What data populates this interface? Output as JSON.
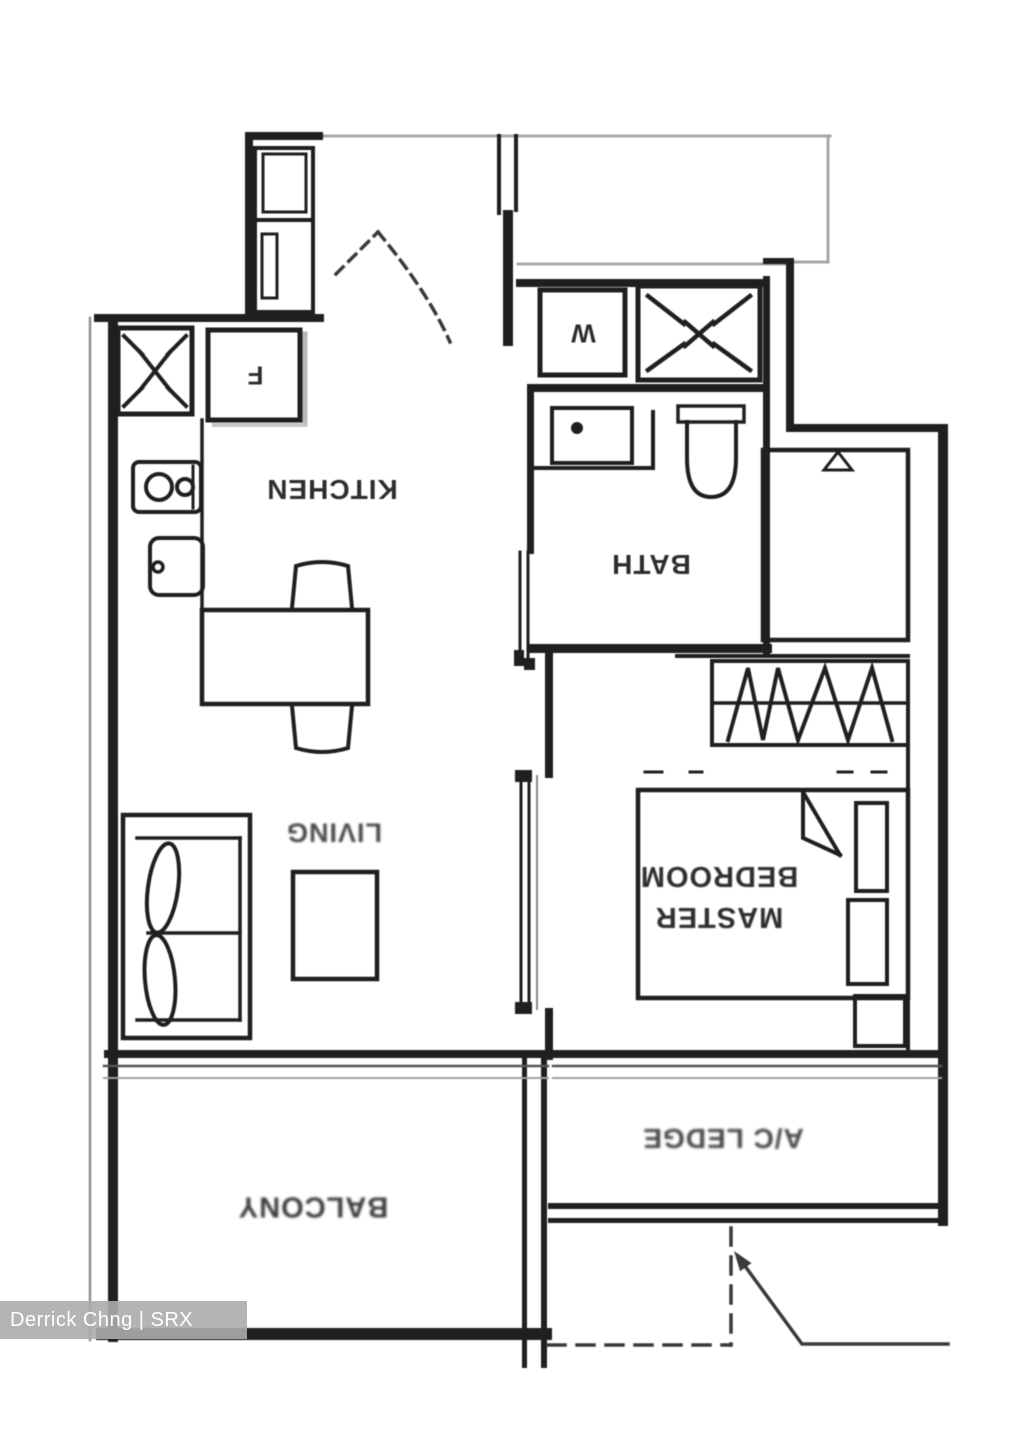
{
  "floorplan": {
    "rooms": {
      "kitchen": "KITCHEN",
      "bath": "BATH",
      "living": "LIVING",
      "master_bedroom_line1": "MASTER",
      "master_bedroom_line2": "BEDROOM",
      "balcony": "BALCONY",
      "ac_ledge": "A/C LEDGE"
    },
    "appliances": {
      "washer": "W",
      "fridge": "F"
    }
  },
  "watermark": {
    "text": "Derrick Chng | SRX PROPERTY"
  },
  "colors": {
    "line": "#1f1f1f",
    "light_line": "#a6a6a6",
    "label": "#2e2e2e",
    "watermark_bg": "#acacac",
    "watermark_text": "#ffffff",
    "background": "#ffffff"
  }
}
